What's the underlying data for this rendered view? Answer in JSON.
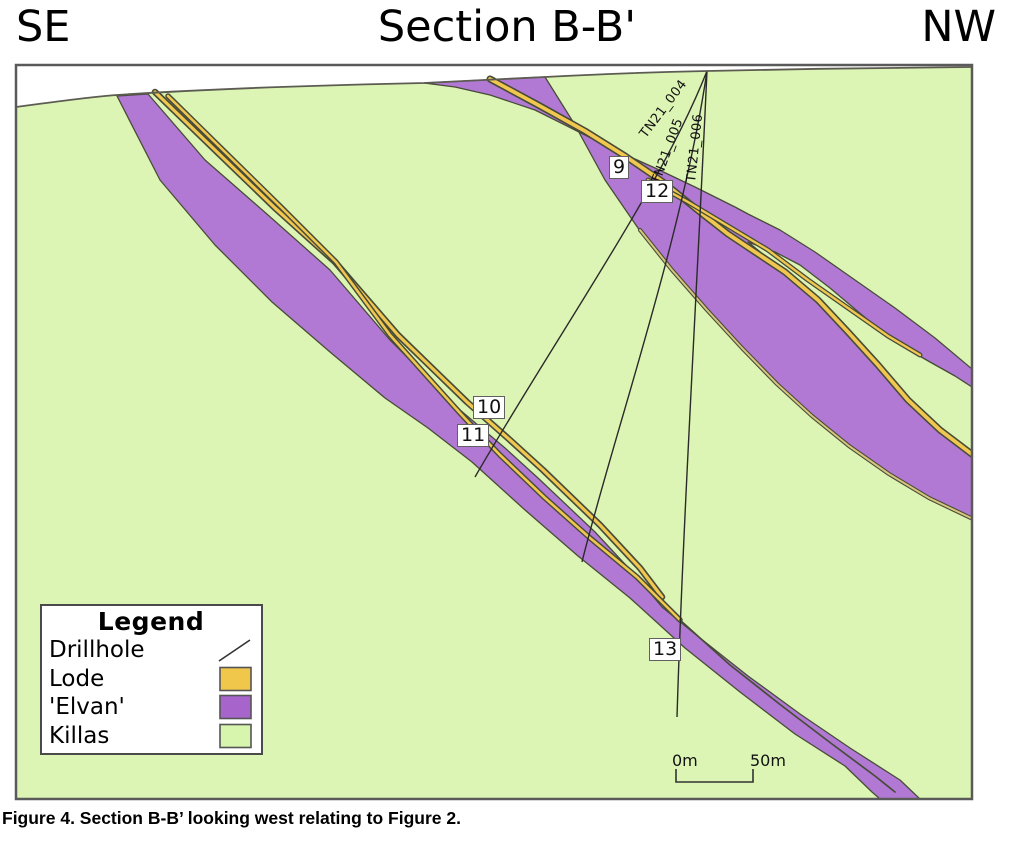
{
  "header": {
    "left": "SE",
    "title": "Section B-B'",
    "right": "NW"
  },
  "caption": "Figure 4. Section B-B’ looking west relating to Figure 2.",
  "drillholes": {
    "d004": "TN21_004",
    "d005": "TN21_005",
    "d006": "TN21_006"
  },
  "markers": {
    "m9": "9",
    "m10": "10",
    "m11": "11",
    "m12": "12",
    "m13": "13"
  },
  "scalebar": {
    "left": "0m",
    "right": "50m"
  },
  "legend": {
    "title": "Legend",
    "items": [
      {
        "label": "Drillhole",
        "type": "line"
      },
      {
        "label": "Lode",
        "type": "swatch",
        "color": "#f0c64b"
      },
      {
        "label": "'Elvan'",
        "type": "swatch",
        "color": "#a765cc"
      },
      {
        "label": "Killas",
        "type": "swatch",
        "color": "#d8f5ad"
      }
    ]
  },
  "colors": {
    "sky": "#ffffff",
    "killas": "#ddf5b4",
    "elvan": "#b179d4",
    "lode": "#f1c74f",
    "lode_tan": "#d8c57d",
    "drillhole": "#2a2a2a"
  }
}
